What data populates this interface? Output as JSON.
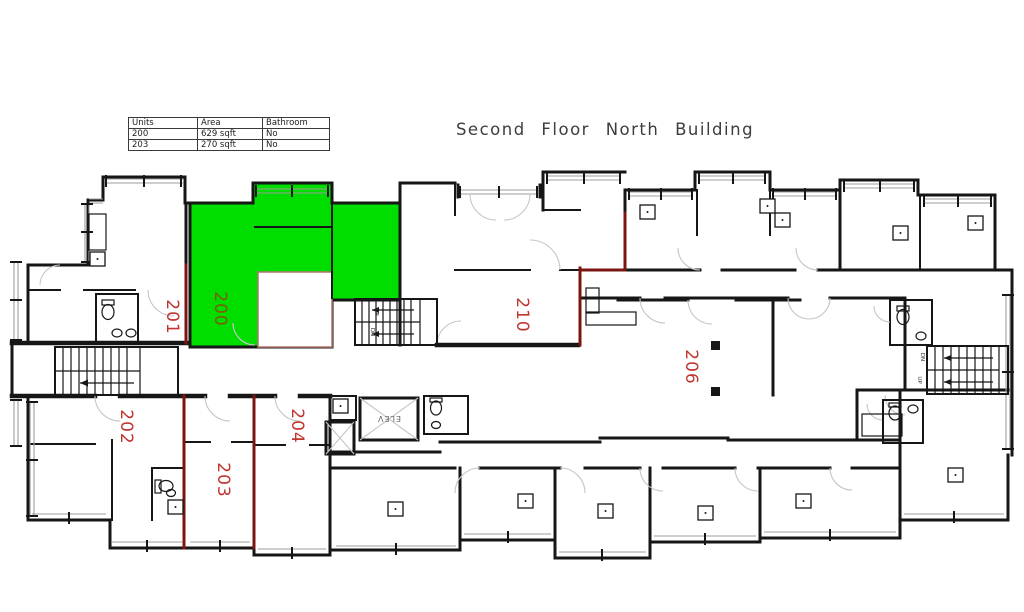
{
  "page": {
    "title": "Second Floor North Building"
  },
  "legend_table": {
    "headers": [
      "Units",
      "Area",
      "Bathroom"
    ],
    "rows": [
      {
        "unit": "200",
        "area": "629  sqft",
        "bathroom": "No"
      },
      {
        "unit": "203",
        "area": "270  sqft",
        "bathroom": "No"
      }
    ]
  },
  "floor_plan": {
    "highlighted_unit": "200",
    "colors": {
      "highlight_fill": "#00DE00",
      "unit_label": "#C13530",
      "highlighted_unit_label": "#7A5C04",
      "party_wall": "#7A1510",
      "wall": "#161616"
    },
    "units": [
      {
        "label": "201",
        "highlighted": false
      },
      {
        "label": "200",
        "highlighted": true
      },
      {
        "label": "210",
        "highlighted": false
      },
      {
        "label": "206",
        "highlighted": false
      },
      {
        "label": "202",
        "highlighted": false
      },
      {
        "label": "203",
        "highlighted": false
      },
      {
        "label": "204",
        "highlighted": false
      }
    ],
    "annotations": {
      "elevator": "ELEV",
      "janitor": "JAN",
      "stair_up": "UP",
      "stair_down": "DN"
    }
  }
}
